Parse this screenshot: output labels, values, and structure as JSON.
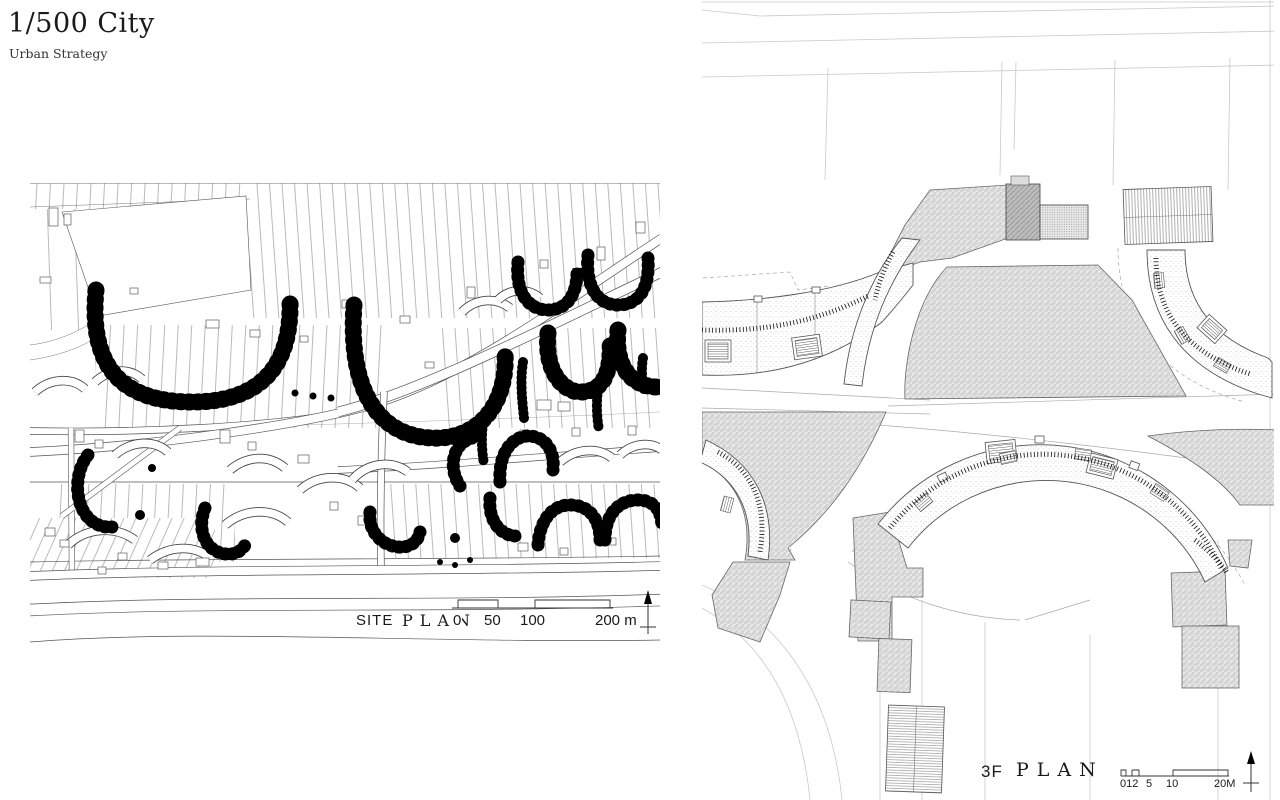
{
  "header": {
    "title": "1/500 City",
    "subtitle": "Urban Strategy"
  },
  "site_plan": {
    "label_site": "SITE",
    "label_plan": "PLAN",
    "scale_ticks": [
      "0",
      "50",
      "100",
      "200 m"
    ]
  },
  "floor_plan": {
    "label_level": "3F",
    "label_plan": "PLAN",
    "scale_ticks": [
      "012",
      "5",
      "10",
      "20M"
    ]
  },
  "icons": {
    "north_arrow_left": "north-arrow",
    "north_arrow_right": "north-arrow"
  },
  "colors": {
    "ink": "#1a1a1a",
    "drawing_line": "#555555",
    "faint_line": "#c9c9c9",
    "roof_gray": "#d8d8d8",
    "tree_black": "#000000"
  }
}
